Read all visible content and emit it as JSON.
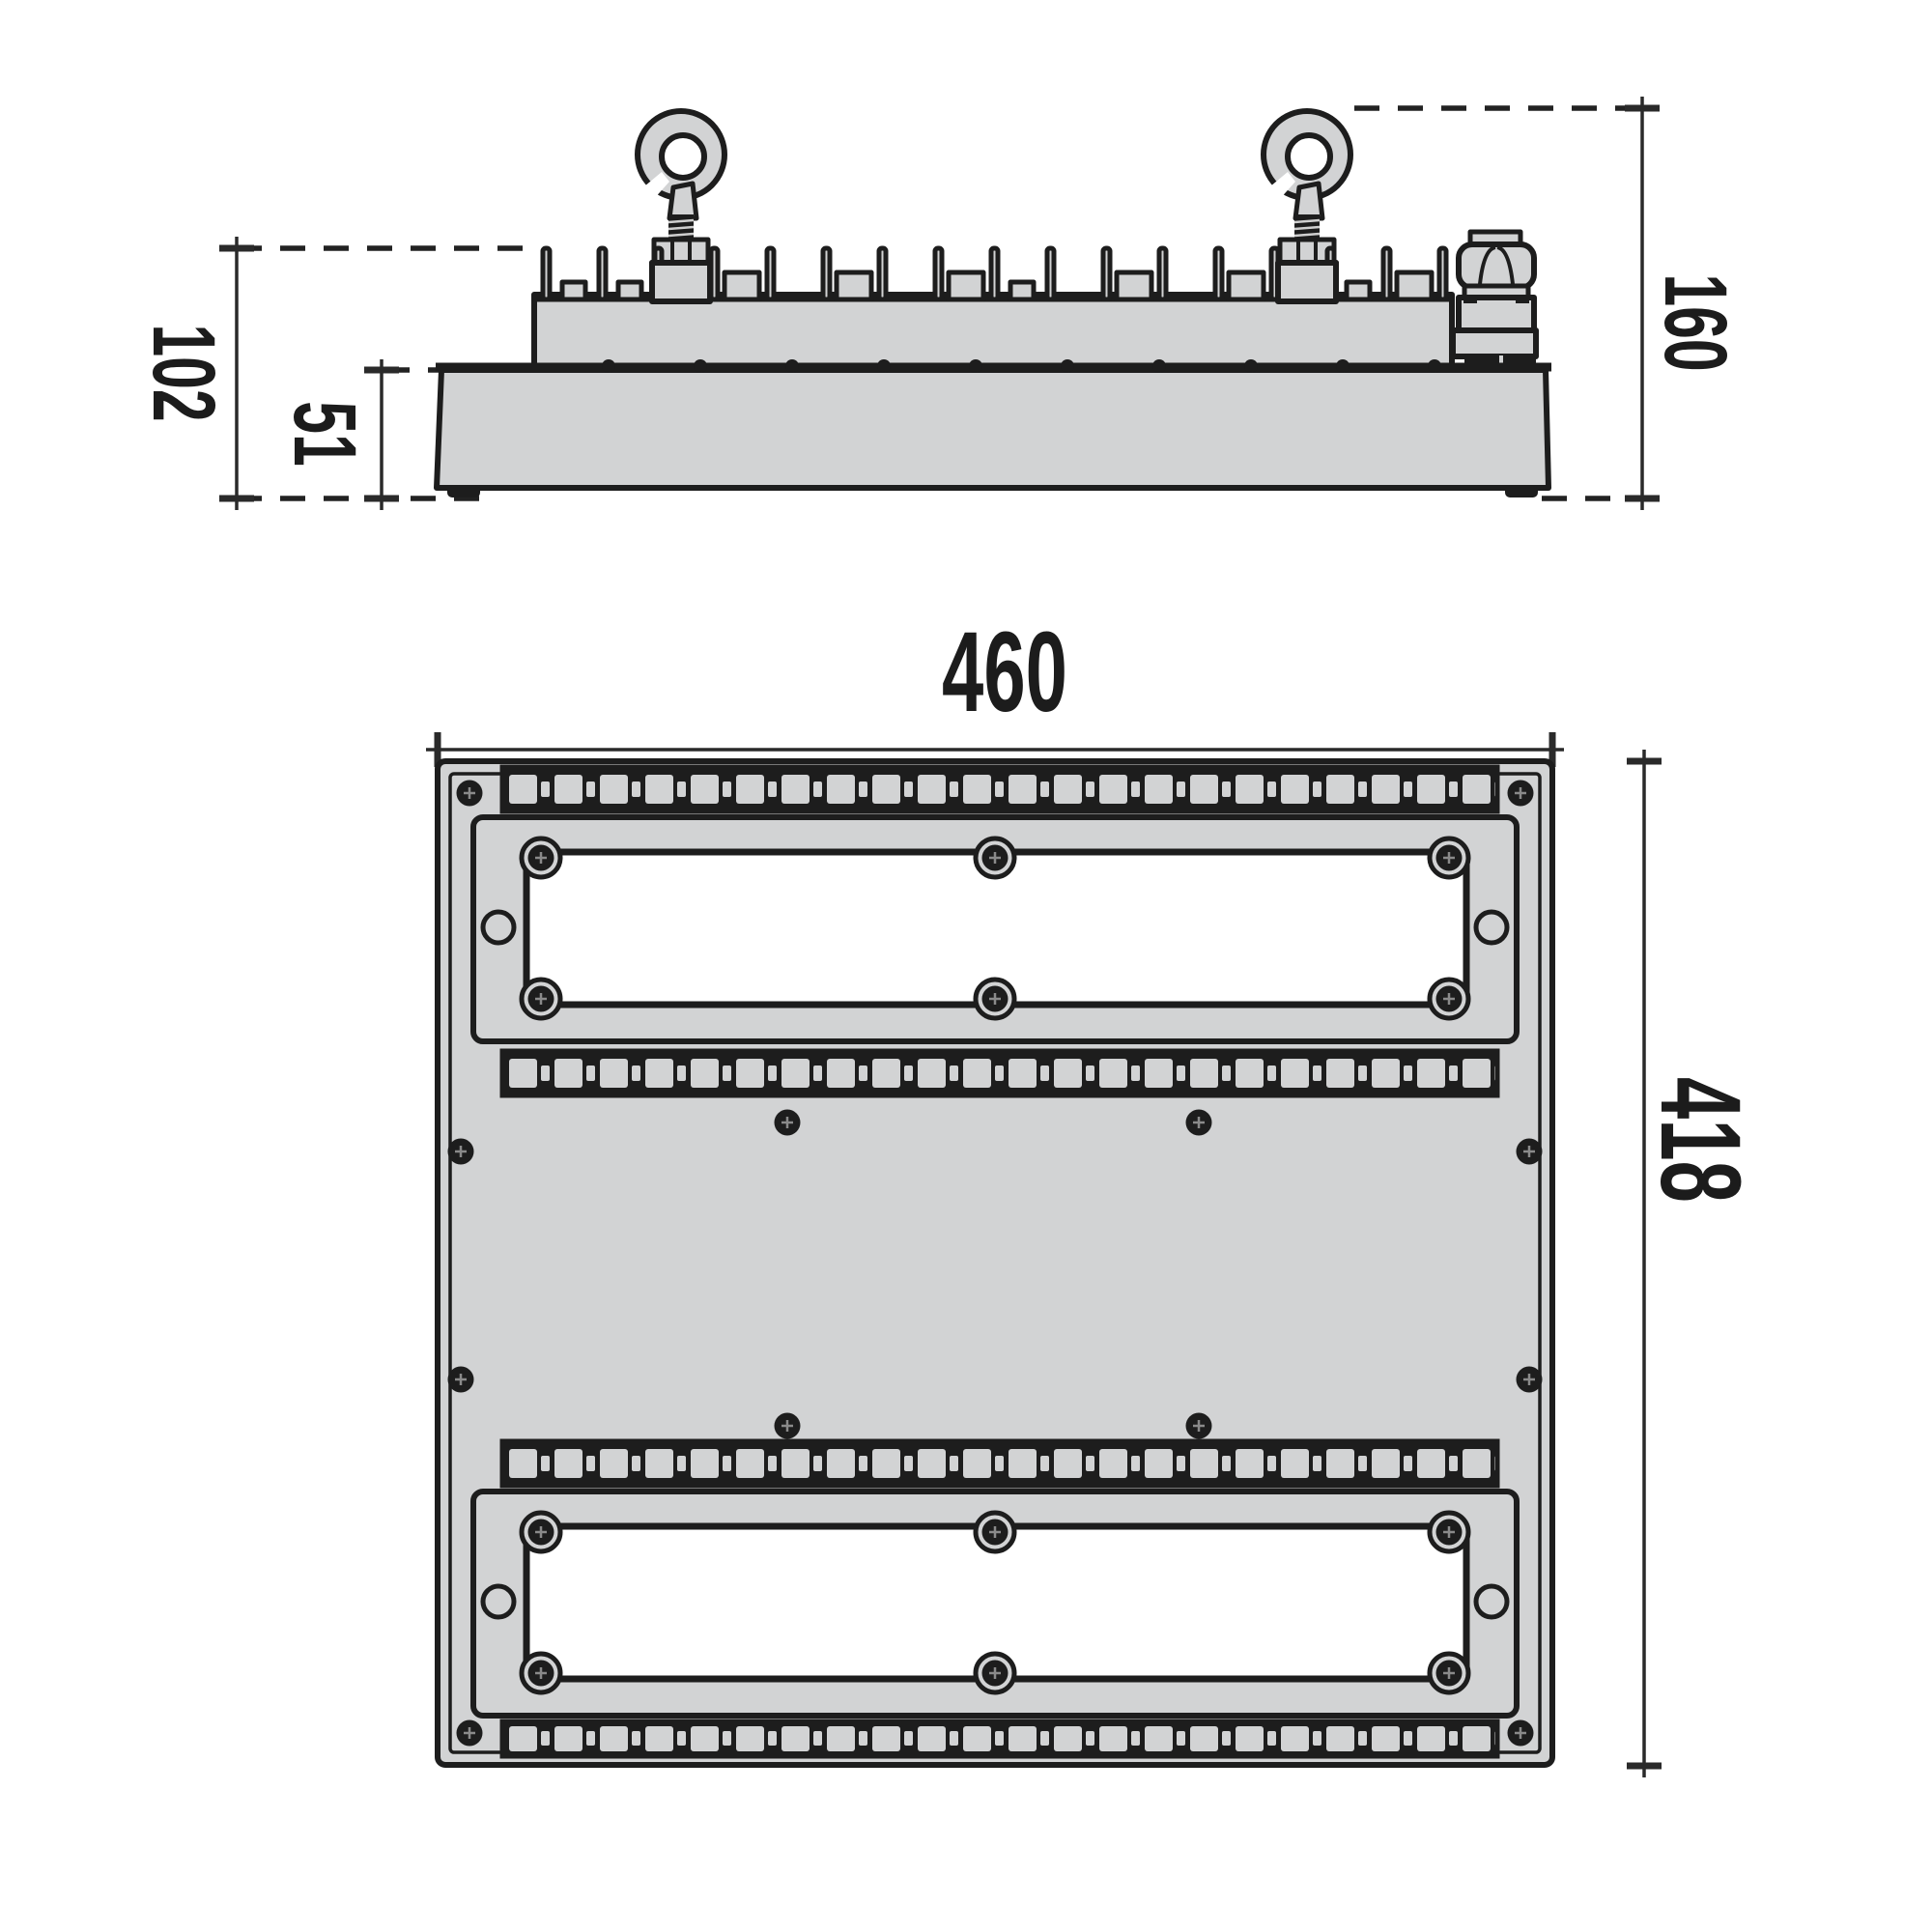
{
  "drawing": {
    "description": "technical-dimension-drawing-of-linear-highbay-luminaire",
    "colors": {
      "outline": "#1d1d1d",
      "body_fill": "#d2d3d4",
      "background": "#ffffff",
      "dimension_lines": "#2a2a2a",
      "led_opening": "#ffffff"
    },
    "side_view": {
      "height_overall": "160",
      "height_body": "102",
      "height_base": "51"
    },
    "plan_view": {
      "width": "460",
      "depth": "418"
    }
  }
}
